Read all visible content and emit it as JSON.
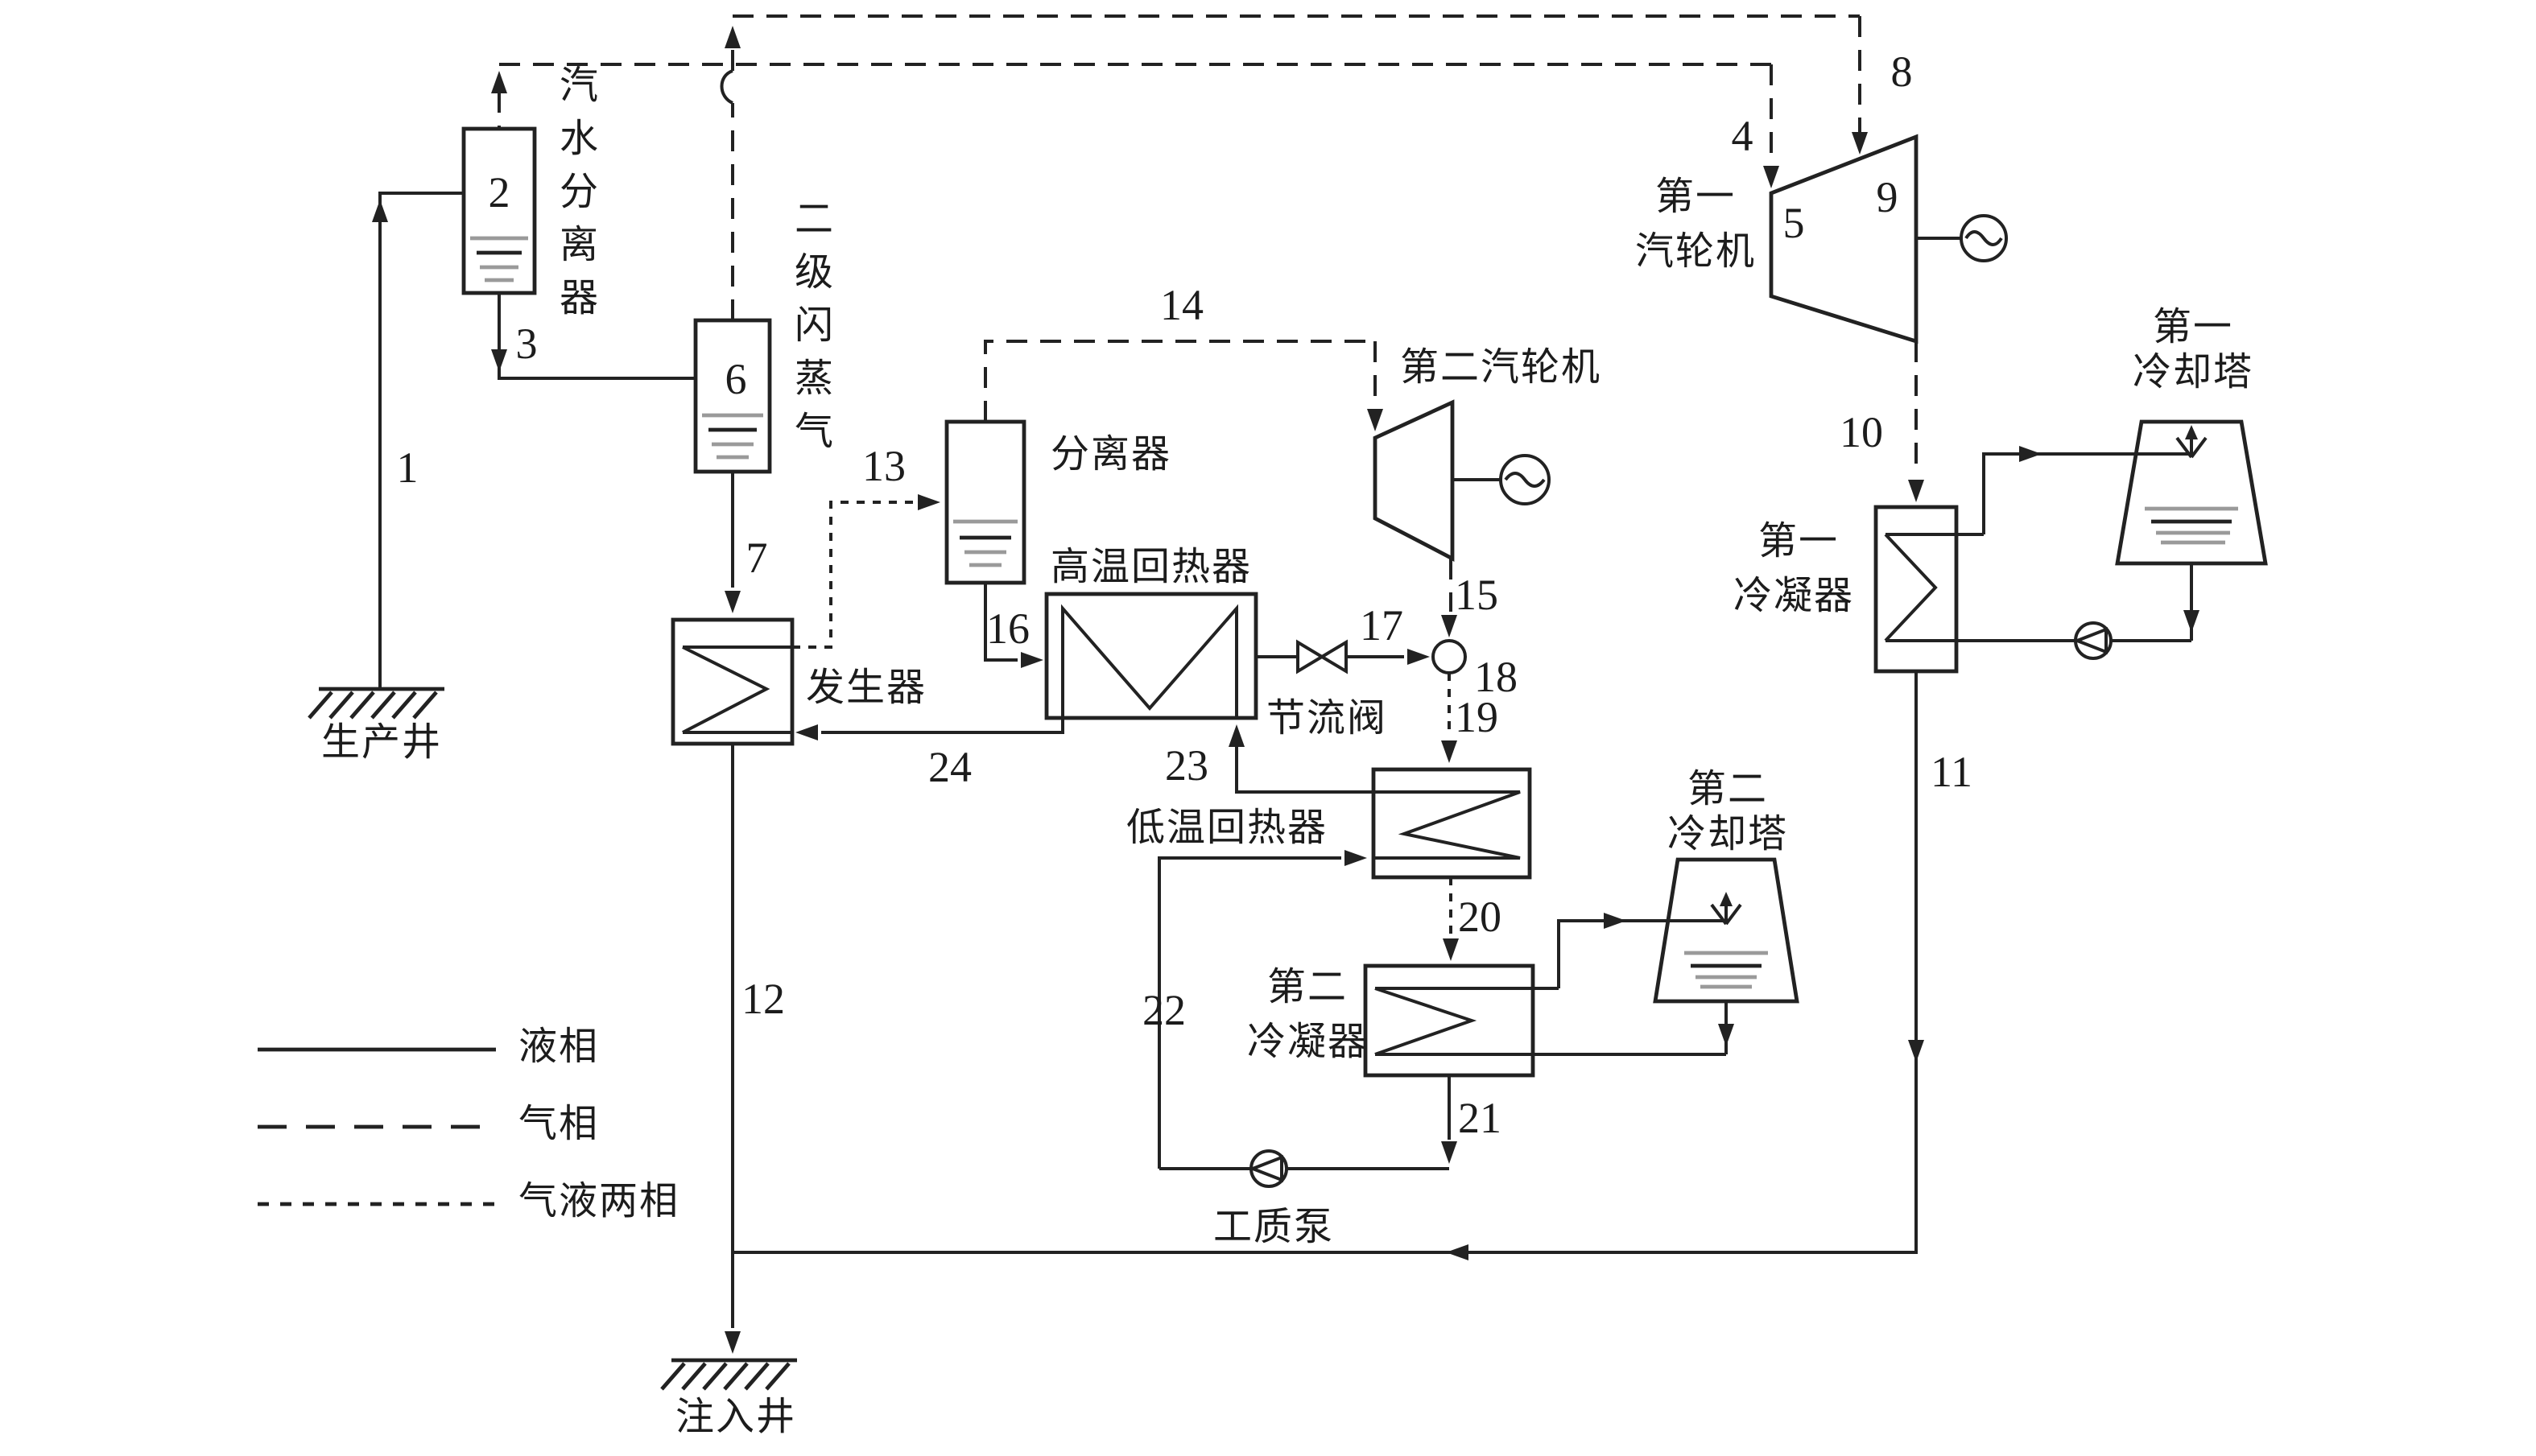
{
  "diagram": {
    "type": "geothermal-flash-binary-power-plant-flow-diagram",
    "numbers": {
      "1": "1",
      "2": "2",
      "3": "3",
      "4": "4",
      "5": "5",
      "6": "6",
      "7": "7",
      "8": "8",
      "9": "9",
      "10": "10",
      "11": "11",
      "12": "12",
      "13": "13",
      "14": "14",
      "15": "15",
      "16": "16",
      "17": "17",
      "18": "18",
      "19": "19",
      "20": "20",
      "21": "21",
      "22": "22",
      "23": "23",
      "24": "24"
    },
    "equipment": {
      "steam_water_separator": "汽水分离器",
      "secondary_flash_steam": "二级闪蒸气",
      "separator": "分离器",
      "generator": "发生器",
      "high_temp_regenerator": "高温回热器",
      "low_temp_regenerator": "低温回热器",
      "throttle_valve": "节流阀",
      "first_turbine_line1": "第一",
      "first_turbine_line2": "汽轮机",
      "second_turbine": "第二汽轮机",
      "first_condenser_line1": "第一",
      "first_condenser_line2": "冷凝器",
      "first_cooling_tower_line1": "第一",
      "first_cooling_tower_line2": "冷却塔",
      "second_condenser_line1": "第二",
      "second_condenser_line2": "冷凝器",
      "second_cooling_tower_line1": "第二",
      "second_cooling_tower_line2": "冷却塔",
      "working_fluid_pump": "工质泵",
      "production_well": "生产井",
      "injection_well": "注入井"
    },
    "legend": {
      "liquid_phase": "液相",
      "gas_phase": "气相",
      "two_phase": "气液两相"
    },
    "colors": {
      "line": "#222222",
      "level_line_gray": "#9a9a9a",
      "background": "#ffffff"
    }
  }
}
